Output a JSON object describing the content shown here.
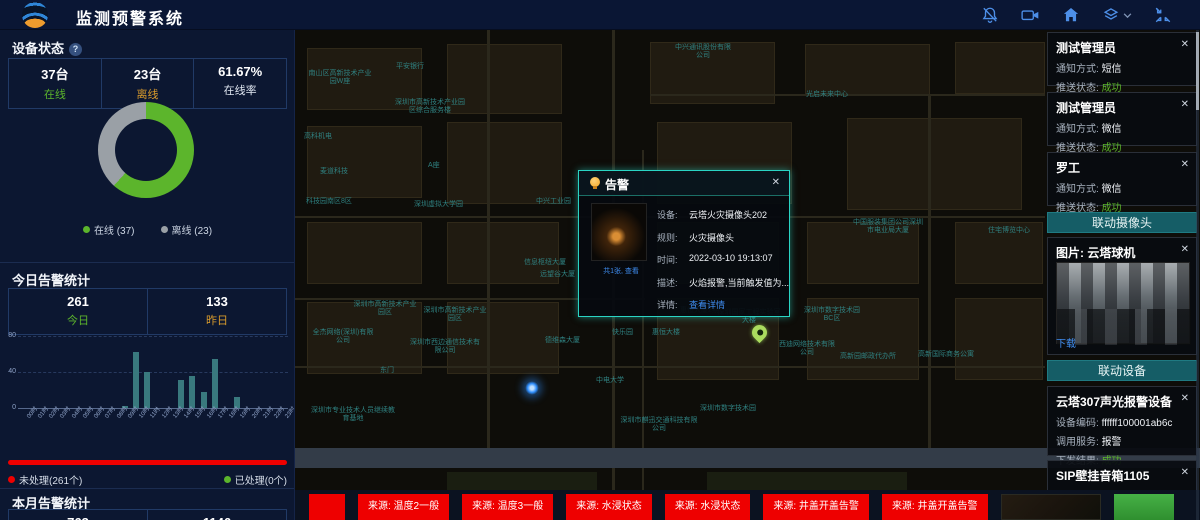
{
  "header": {
    "title": "监测预警系统",
    "icons": [
      "bell-off-icon",
      "video-camera-icon",
      "home-icon",
      "layers-icon",
      "fullscreen-icon"
    ]
  },
  "left_panel": {
    "device_status": {
      "title": "设备状态",
      "stats": [
        {
          "value": "37台",
          "label": "在线",
          "color": "#5cb52c"
        },
        {
          "value": "23台",
          "label": "离线",
          "color": "#d99b2c"
        },
        {
          "value": "61.67%",
          "label": "在线率",
          "color": "#dfe6f0"
        }
      ],
      "legend": [
        {
          "label": "在线 (37)",
          "color": "#5cb52c"
        },
        {
          "label": "离线 (23)",
          "color": "#9aa0a6"
        }
      ]
    },
    "today_alerts": {
      "title": "今日告警统计",
      "stats": [
        {
          "value": "261",
          "label": "今日",
          "color": "#5cb52c"
        },
        {
          "value": "133",
          "label": "昨日",
          "color": "#d99b2c"
        }
      ]
    },
    "processing": {
      "unprocessed": "未处理(261个)",
      "processed": "已处理(0个)",
      "bar_color": "#ee0000"
    },
    "month_alerts": {
      "title": "本月告警统计",
      "values": [
        "763",
        "1146"
      ]
    }
  },
  "chart_data": [
    {
      "type": "pie",
      "title": "设备状态",
      "labels": [
        "在线",
        "离线"
      ],
      "values": [
        37,
        23
      ],
      "colors": [
        "#5cb52c",
        "#9aa0a6"
      ],
      "donut": true,
      "legend_position": "bottom"
    },
    {
      "type": "bar",
      "title": "今日告警统计",
      "categories": [
        "00时",
        "01时",
        "02时",
        "03时",
        "04时",
        "05时",
        "06时",
        "07时",
        "08时",
        "09时",
        "10时",
        "11时",
        "12时",
        "13时",
        "14时",
        "15时",
        "16时",
        "17时",
        "18时",
        "19时",
        "20时",
        "21时",
        "22时",
        "23时"
      ],
      "values": [
        0,
        0,
        0,
        0,
        0,
        0,
        0,
        0,
        0,
        2,
        62,
        40,
        0,
        0,
        31,
        36,
        18,
        54,
        0,
        12,
        0,
        0,
        0,
        0
      ],
      "xlabel": "",
      "ylabel": "",
      "ylim": [
        0,
        80
      ],
      "y_ticks": [
        0,
        40,
        80
      ],
      "grid": "dashed",
      "color": "#39797e"
    }
  ],
  "map": {
    "labels": [
      {
        "t": "中兴通讯股份有限公司",
        "x": 377,
        "y": 14,
        "w": 62
      },
      {
        "t": "平安银行",
        "x": 101,
        "y": 33
      },
      {
        "t": "南山区高新技术产业园W座",
        "x": 13,
        "y": 40,
        "w": 64
      },
      {
        "t": "深圳市高新技术产业园区综合服务楼",
        "x": 97,
        "y": 69,
        "w": 76
      },
      {
        "t": "光启未来中心",
        "x": 511,
        "y": 61
      },
      {
        "t": "高科机电",
        "x": 9,
        "y": 103
      },
      {
        "t": "麦道科技",
        "x": 25,
        "y": 138
      },
      {
        "t": "A座",
        "x": 133,
        "y": 132
      },
      {
        "t": "科技园南区8区",
        "x": 11,
        "y": 168
      },
      {
        "t": "深圳虚拟大学园",
        "x": 119,
        "y": 171
      },
      {
        "t": "中兴工业园",
        "x": 241,
        "y": 168
      },
      {
        "t": "便利店",
        "x": 323,
        "y": 199
      },
      {
        "t": "信息枢纽大厦",
        "x": 229,
        "y": 229
      },
      {
        "t": "中国服装集团公司深圳市电业局大厦",
        "x": 557,
        "y": 189,
        "w": 72
      },
      {
        "t": "住宅博览中心",
        "x": 693,
        "y": 197
      },
      {
        "t": "深圳市高新技术产业园区",
        "x": 57,
        "y": 271,
        "w": 66
      },
      {
        "t": "深圳市高新技术产业园区",
        "x": 127,
        "y": 277,
        "w": 66
      },
      {
        "t": "全杰网络(深圳)有限公司",
        "x": 17,
        "y": 299,
        "w": 62
      },
      {
        "t": "深圳市西边通信技术有限公司",
        "x": 113,
        "y": 309,
        "w": 74
      },
      {
        "t": "远望谷大厦",
        "x": 245,
        "y": 241
      },
      {
        "t": "德维森大厦",
        "x": 250,
        "y": 307
      },
      {
        "t": "快乐园",
        "x": 317,
        "y": 299
      },
      {
        "t": "惠恒大楼",
        "x": 357,
        "y": 299
      },
      {
        "t": "惠恒大厦2期",
        "x": 385,
        "y": 277
      },
      {
        "t": "中电大学",
        "x": 301,
        "y": 347
      },
      {
        "t": "东门",
        "x": 85,
        "y": 337
      },
      {
        "t": "深圳市专业技术人员继续教育基地",
        "x": 15,
        "y": 377,
        "w": 86
      },
      {
        "t": "深圳市麒迅交通科技有限公司",
        "x": 325,
        "y": 387,
        "w": 78
      },
      {
        "t": "深圳国家工程实验室大楼",
        "x": 421,
        "y": 279,
        "w": 66
      },
      {
        "t": "深圳市数字技术园BC区",
        "x": 505,
        "y": 277,
        "w": 64
      },
      {
        "t": "西迪网络技术有限公司",
        "x": 483,
        "y": 311,
        "w": 58
      },
      {
        "t": "高新园邮政代办所",
        "x": 545,
        "y": 323
      },
      {
        "t": "深圳市数字技术园",
        "x": 405,
        "y": 375
      },
      {
        "t": "高新国际商务公寓",
        "x": 623,
        "y": 321
      }
    ],
    "markers": {
      "alert_pin": {
        "x": 457,
        "y": 295
      },
      "alert_dot": {
        "x": 230,
        "y": 351
      }
    }
  },
  "popup": {
    "title": "告警",
    "close": "✕",
    "thumbnail_caption": "共1张, 查看",
    "rows": [
      {
        "label": "设备:",
        "value": "云塔火灾摄像头202"
      },
      {
        "label": "规则:",
        "value": "火灾摄像头"
      },
      {
        "label": "时间:",
        "value": "2022-03-10 19:13:07"
      },
      {
        "label": "描述:",
        "value": "火焰报警,当前触发值为..."
      },
      {
        "label": "详情:",
        "value": "查看详情"
      }
    ]
  },
  "right_panel": {
    "notifications": [
      {
        "name": "测试管理员",
        "method_label": "通知方式:",
        "method": "短信",
        "status_label": "推送状态:",
        "status": "成功",
        "close": "✕"
      },
      {
        "name": "测试管理员",
        "method_label": "通知方式:",
        "method": "微信",
        "status_label": "推送状态:",
        "status": "成功",
        "close": "✕"
      },
      {
        "name": "罗工",
        "method_label": "通知方式:",
        "method": "微信",
        "status_label": "推送状态:",
        "status": "成功",
        "close": "✕"
      }
    ],
    "camera_section": {
      "header": "联动摄像头",
      "card": {
        "title": "图片: 云塔球机",
        "download": "下载",
        "close": "✕"
      }
    },
    "device_section": {
      "header": "联动设备",
      "cards": [
        {
          "title": "云塔307声光报警设备",
          "close": "✕",
          "rows": [
            {
              "label": "设备编码:",
              "value": "ffffff100001ab6c"
            },
            {
              "label": "调用服务:",
              "value": "报警"
            },
            {
              "label": "下发结果:",
              "value": "成功"
            }
          ]
        },
        {
          "title": "SIP壁挂音箱1105",
          "close": "✕",
          "rows": [
            {
              "label": "设备编码:",
              "value": "1105"
            }
          ]
        }
      ]
    }
  },
  "ticker": {
    "color": "#ee0000",
    "items": [
      "",
      "来源: 温度2一般",
      "来源: 温度3一般",
      "来源: 水浸状态",
      "来源: 水浸状态",
      "来源: 井盖开盖告警",
      "来源: 井盖开盖告警"
    ]
  }
}
